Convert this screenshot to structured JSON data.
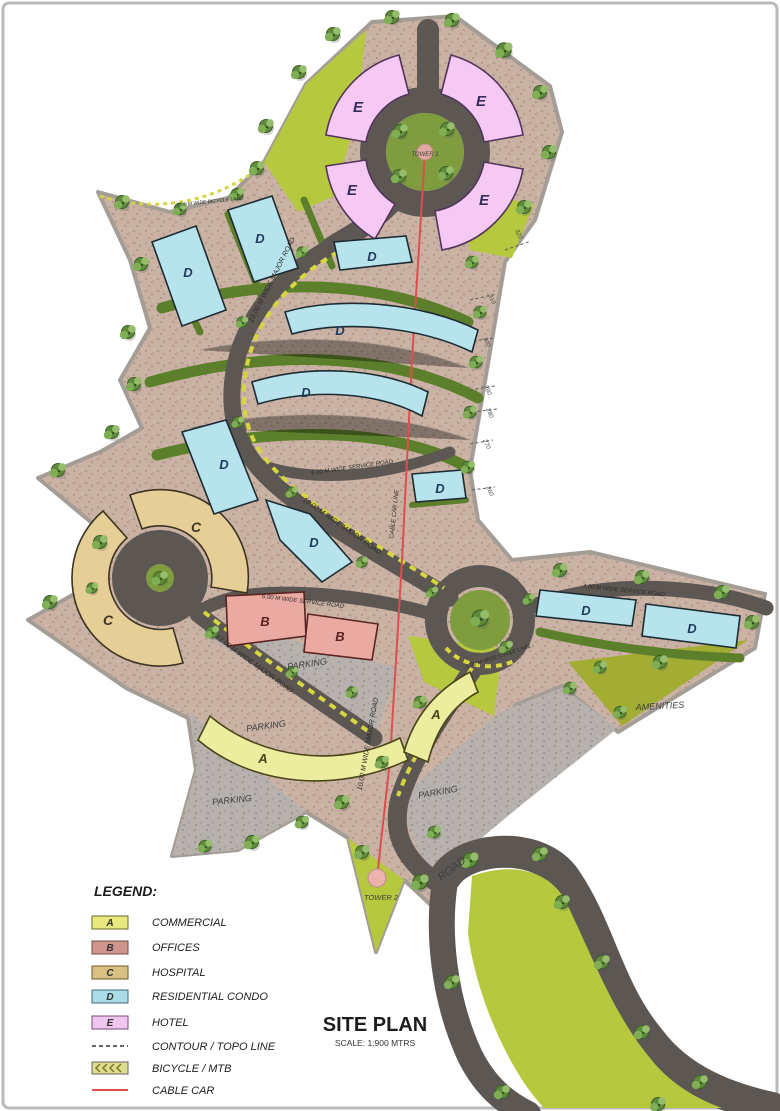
{
  "title": {
    "text": "SITE PLAN",
    "scale": "SCALE: 1:900 MTRS"
  },
  "legend": {
    "title": "LEGEND:",
    "items": [
      {
        "key": "A",
        "label": "COMMERCIAL",
        "color": "#e9e87f"
      },
      {
        "key": "B",
        "label": "OFFICES",
        "color": "#cf948c"
      },
      {
        "key": "C",
        "label": "HOSPITAL",
        "color": "#d9c183"
      },
      {
        "key": "D",
        "label": "RESIDENTIAL CONDO",
        "color": "#a9dce6"
      },
      {
        "key": "E",
        "label": "HOTEL",
        "color": "#eec6ee"
      }
    ],
    "line_items": [
      {
        "type": "contour-line",
        "label": "CONTOUR / TOPO LINE"
      },
      {
        "type": "bicycle-lane",
        "label": "BICYCLE / MTB"
      },
      {
        "type": "cable-car-line",
        "label": "CABLE CAR"
      }
    ]
  },
  "map": {
    "letters": {
      "A": "A",
      "B": "B",
      "C": "C",
      "D": "D",
      "E": "E"
    },
    "labels": {
      "parking": "PARKING",
      "amenities": "AMENITIES",
      "tower1": "TOWER 1",
      "tower2": "TOWER 2",
      "road": "ROAD"
    },
    "road_labels": {
      "major_10": "10.00 M WIDE MAJOR ROAD",
      "major_12": "12.00 M WIDE MAJOR ROAD",
      "service_6": "6.00 M WIDE SERVICE ROAD",
      "service_4": "4.00 M WIDE SERVICE ROAD",
      "cycle_3": "3.00 M WIDE CYCLE LANE",
      "bicycle_lane": "2.00 M WIDE BICYCLE LANE",
      "cable_car": "CABLE CAR LINE"
    },
    "contours": [
      "320",
      "310",
      "300",
      "290",
      "280",
      "270",
      "260"
    ],
    "colors": {
      "road": "#5d5753",
      "gravel": "#c9b2a4",
      "parking_gravel": "#b7b1ae",
      "lawn": "#b5c83e",
      "hedge_green": "#5c7f2b",
      "amenities_olive": "#a4ad33",
      "commercial": "#ededa0",
      "offices": "#eaaaa2",
      "hospital": "#e6cf97",
      "residential_condo": "#b7e3ec",
      "hotel": "#f5c9f3",
      "cable_car": "#dd4f4f",
      "bike_chevron": "#d6d63e"
    }
  }
}
